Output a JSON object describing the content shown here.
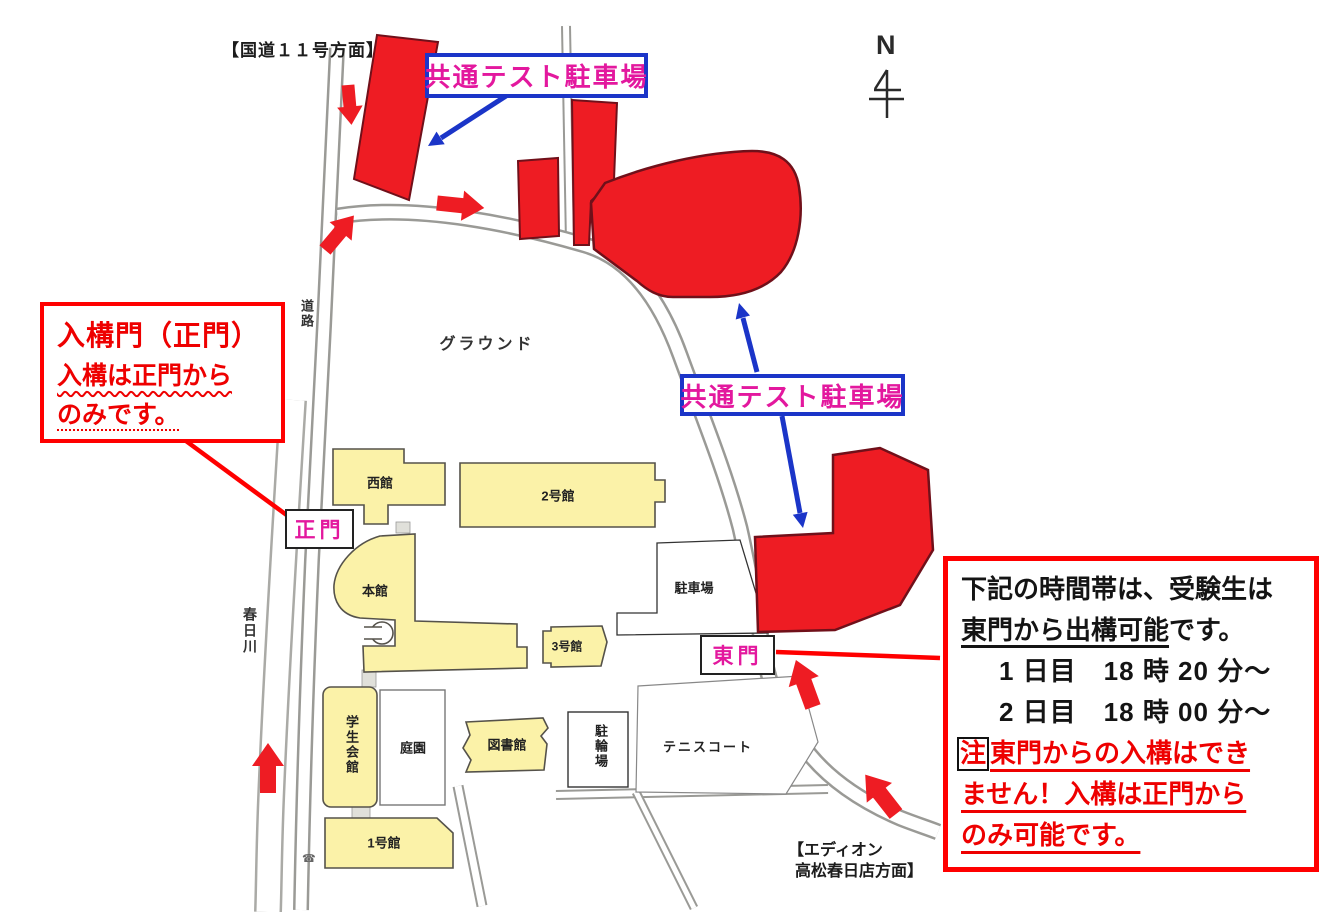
{
  "map": {
    "north_label": "N",
    "directions": {
      "national_route": "【国道１１号方面】",
      "edion_line1": "【エディオン",
      "edion_line2": "高松春日店方面】"
    },
    "labels": {
      "ground": "グラウンド",
      "road": "道路",
      "river": "春日川"
    },
    "callouts": {
      "parking1": "共通テスト駐車場",
      "parking2": "共通テスト駐車場"
    },
    "gates": {
      "main_gate": "正門",
      "east_gate": "東門"
    },
    "buildings": {
      "west_hall": "西館",
      "bldg2": "2号館",
      "main_hall": "本館",
      "bldg3": "3号館",
      "parking_lot": "駐車場",
      "student_hall": "学生会館",
      "garden": "庭園",
      "library": "図書館",
      "bicycle_parking": "駐輪場",
      "tennis_court": "テニスコート",
      "bldg1": "1号館"
    }
  },
  "left_note": {
    "title": "入構門（正門）",
    "line2": "入構は正門から",
    "line3": "のみです。"
  },
  "right_note": {
    "line1": "下記の時間帯は、受験生は",
    "line2_underline": "東門から出構可能",
    "line2_tail": "です。",
    "day1": "1 日目　18 時 20 分～",
    "day2": "2 日目　18 時 00 分～",
    "note_mark": "注",
    "warn1": "東門からの入構はでき",
    "warn2": "ません！入構は正門から",
    "warn3": "のみ可能です。"
  },
  "colors": {
    "parking_red": "#ee1c23",
    "annotation_red": "#ff0000",
    "callout_blue": "#1b35c8",
    "gate_magenta": "#e3189e",
    "building_yellow": "#fbf2a8"
  }
}
